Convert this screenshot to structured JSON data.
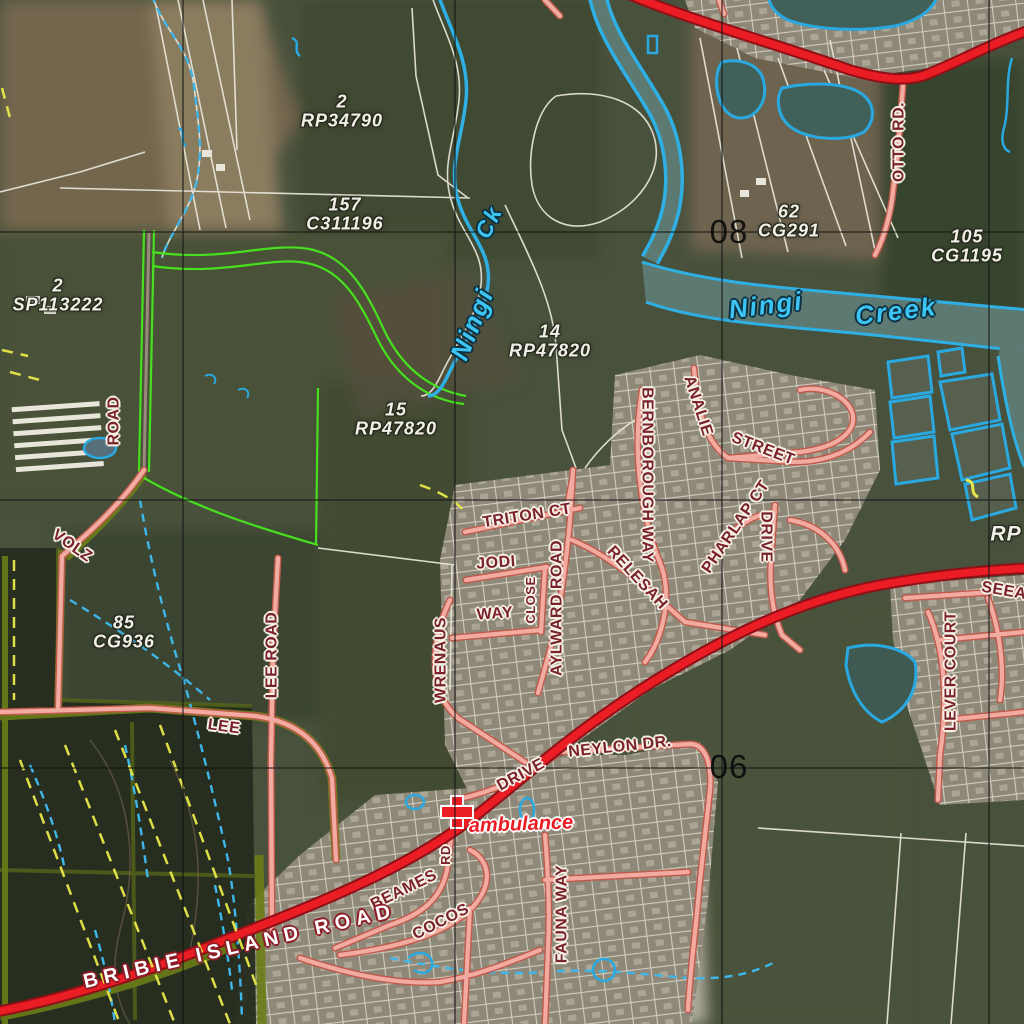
{
  "map": {
    "grid_labels": [
      {
        "text": "08"
      },
      {
        "text": "06"
      }
    ],
    "parcels": [
      {
        "lot": "2",
        "plan": "RP34790"
      },
      {
        "lot": "157",
        "plan": "C311196"
      },
      {
        "lot": "2",
        "plan": "SP113222"
      },
      {
        "lot": "14",
        "plan": "RP47820"
      },
      {
        "lot": "15",
        "plan": "RP47820"
      },
      {
        "lot": "62",
        "plan": "CG291"
      },
      {
        "lot": "105",
        "plan": "CG1195"
      },
      {
        "lot": "85",
        "plan": "CG936"
      },
      {
        "lot": "",
        "plan": "RP"
      }
    ],
    "water_labels": [
      {
        "text": "Ningi"
      },
      {
        "text": "Ck"
      },
      {
        "text": "Ningi"
      },
      {
        "text": "Creek"
      }
    ],
    "road_labels": [
      {
        "text": "OTTO RD."
      },
      {
        "text": "ROAD"
      },
      {
        "text": "VOLZ"
      },
      {
        "text": "LEE ROAD"
      },
      {
        "text": "LEE"
      },
      {
        "text": "TRITON CT"
      },
      {
        "text": "JODI"
      },
      {
        "text": "WAY"
      },
      {
        "text": "CLOSE"
      },
      {
        "text": "AYLWARD ROAD"
      },
      {
        "text": "WRENAUS"
      },
      {
        "text": "RELESAH"
      },
      {
        "text": "BERNBOROUGH WAY"
      },
      {
        "text": "ANALIE"
      },
      {
        "text": "STREET"
      },
      {
        "text": "PHARLAP CT"
      },
      {
        "text": "DRIVE"
      },
      {
        "text": "LEVER COURT"
      },
      {
        "text": "SEEA"
      },
      {
        "text": "NEYLON DR."
      },
      {
        "text": "DRIVE"
      },
      {
        "text": "BEAMES"
      },
      {
        "text": "RD"
      },
      {
        "text": "COCOS"
      },
      {
        "text": "FAUNA WAY"
      },
      {
        "text": "BRIBIE ISLAND ROAD"
      }
    ],
    "poi": {
      "ambulance": "ambulance"
    },
    "colors": {
      "major_road": "#ea1c24",
      "minor_road": "#f2aba1",
      "water_outline": "#2fb0e4",
      "water_fill": "#5d7a72",
      "reserve_green": "#46e01e",
      "road_label": "#7a222e",
      "parcel_label": "#f2f0e6",
      "ambulance": "#ea1c24"
    }
  }
}
